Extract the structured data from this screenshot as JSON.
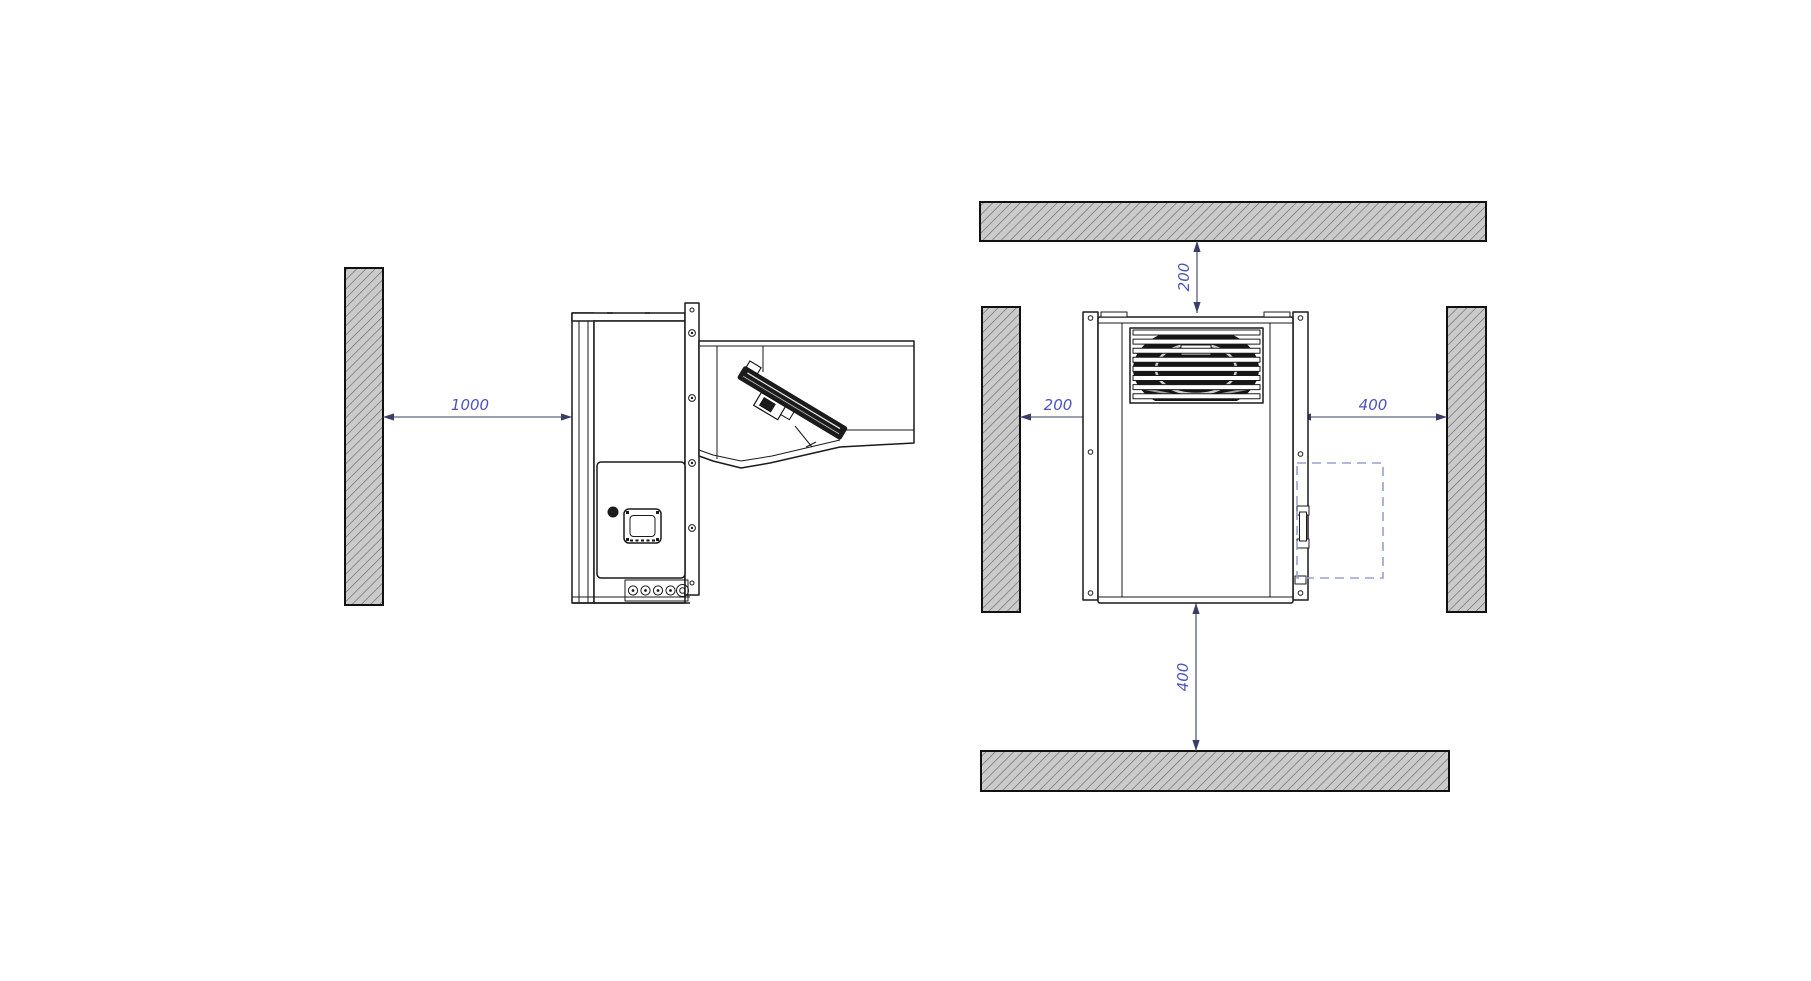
{
  "side_view": {
    "wall_clearance_label": "1000"
  },
  "front_view": {
    "top_clearance_label": "200",
    "left_clearance_label": "200",
    "right_clearance_label": "400",
    "bottom_clearance_label": "400"
  },
  "colors": {
    "dimension_line": "#3a3d66",
    "dimension_text": "#4d52bb",
    "drawing_line": "#1a1a1a",
    "wall_fill": "#cbcbcb",
    "wall_hatch": "#707070",
    "service_area_dash": "#98a0cf",
    "background": "#ffffff"
  }
}
